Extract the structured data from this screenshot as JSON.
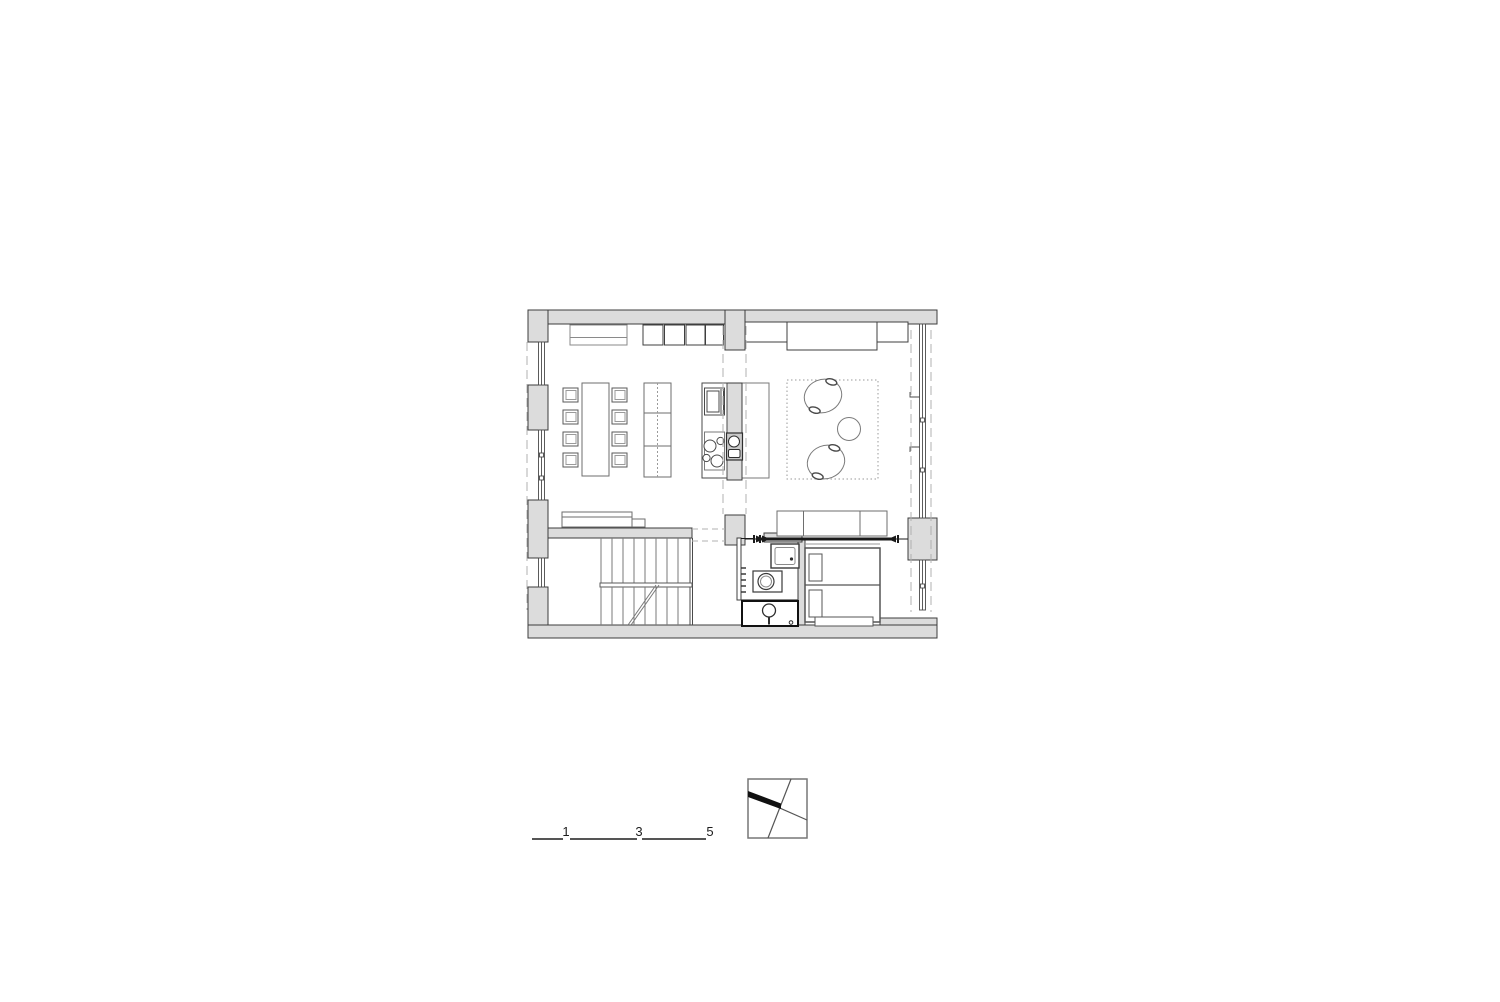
{
  "canvas": {
    "background": "#ffffff"
  },
  "drawing": {
    "kind": "architectural-floor-plan",
    "colors": {
      "wall_fill": "#dcdcdc",
      "wall_outline": "#3c3c3c",
      "furniture_line": "#7a7a7a",
      "detail_dark": "#1c1c1c",
      "dashed_guide": "#b0b0b0",
      "rug_dotted": "#9a9a9a"
    },
    "elements": [
      "walls",
      "windows",
      "dining-table",
      "dining-chairs",
      "shelf-unit",
      "sideboard",
      "wall-cabinets",
      "kitchen-counter",
      "oven",
      "cooktop",
      "kitchen-island",
      "island-sink",
      "rug",
      "armchairs",
      "side-table",
      "sofa",
      "media-cabinets",
      "bench",
      "stairs",
      "bathroom",
      "washbasin",
      "sink-unit",
      "toilet",
      "bed",
      "sliding-doors"
    ]
  },
  "scale_bar": {
    "labels": [
      "1",
      "3",
      "5"
    ]
  },
  "icons": {
    "north_arrow": "north-arrow-icon"
  }
}
